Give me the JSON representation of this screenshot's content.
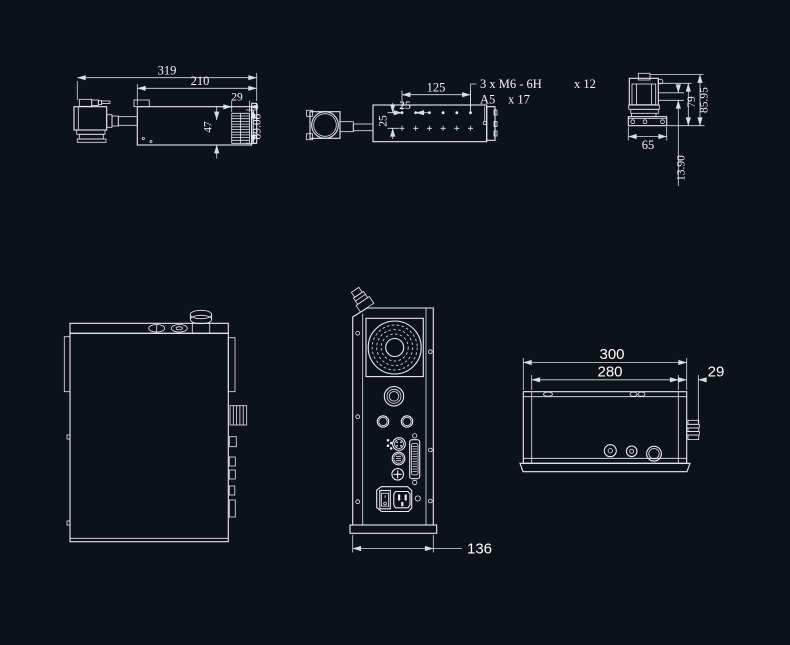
{
  "canvas": {
    "background": "#0d1218",
    "line_color": "#e8ecf1",
    "dim_color": "#d9dee5",
    "text_color": "#f3f5f8"
  },
  "views": {
    "head_side": {
      "dim_overall_length": "319",
      "dim_body_length": "210",
      "dim_fin_width": "29",
      "dim_front_height": "47",
      "dim_rear_height": "89.08"
    },
    "head_top": {
      "dim_hole_span": "125",
      "dim_hole_offset": "25",
      "dim_row_spacing": "25",
      "note_thread": "3 x M6 - 6H",
      "note_thread_depth": "x 12",
      "note_pin_hole": "A5",
      "note_pin_depth": "x 17"
    },
    "head_front": {
      "dim_base_width": "65",
      "dim_body_height": "79",
      "dim_overall_height": "85.95",
      "dim_beam_offset": "13.90"
    },
    "box_rear": {
      "dim_depth": "136"
    },
    "box_top": {
      "dim_overall_width": "300",
      "dim_body_width": "280",
      "dim_knob_depth": "29"
    }
  }
}
